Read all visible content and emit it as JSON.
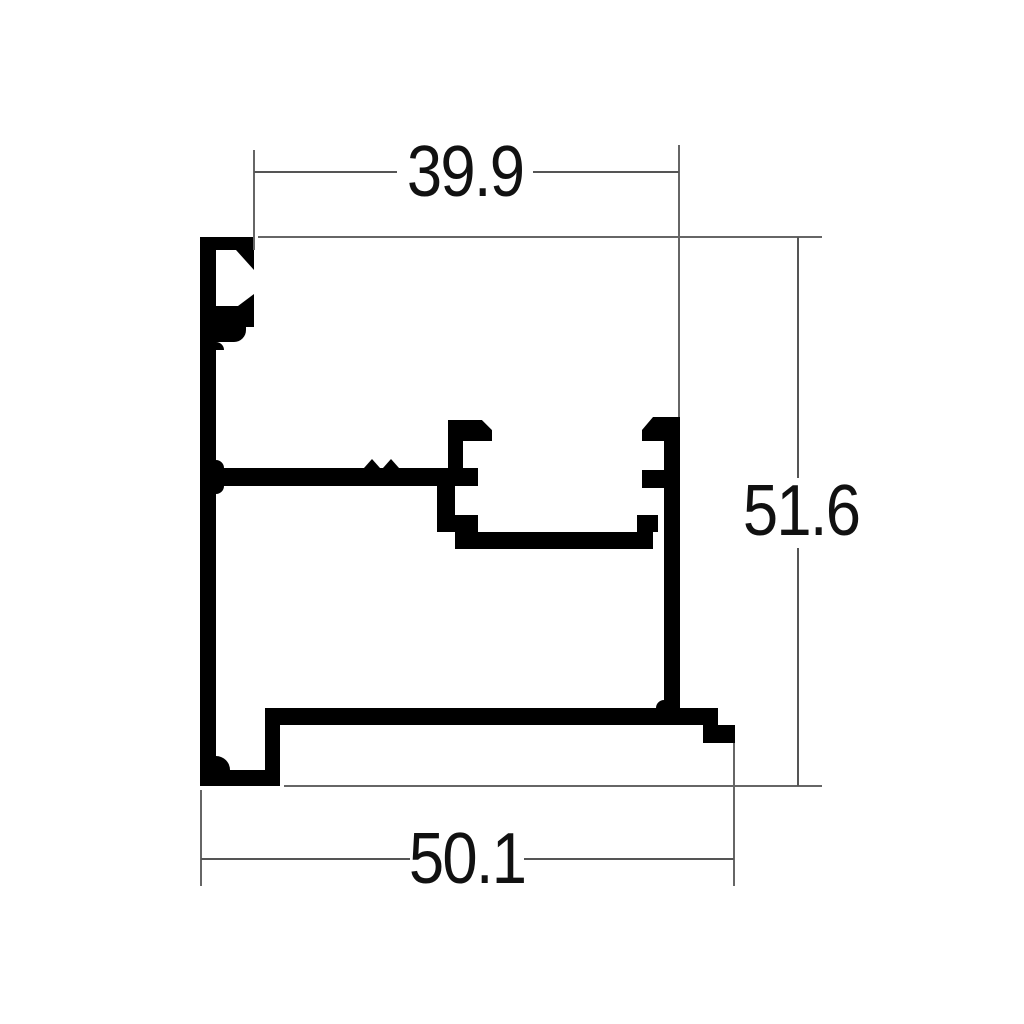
{
  "drawing": {
    "kind": "aluminium-profile-cross-section",
    "background_color": "#ffffff",
    "profile_color": "#000000",
    "dimension_line_color": "#555555",
    "text_color": "#111111",
    "dimensions": {
      "top_width": {
        "value": "39.9"
      },
      "right_height": {
        "value": "51.6"
      },
      "bottom_width": {
        "value": "50.1"
      }
    }
  }
}
